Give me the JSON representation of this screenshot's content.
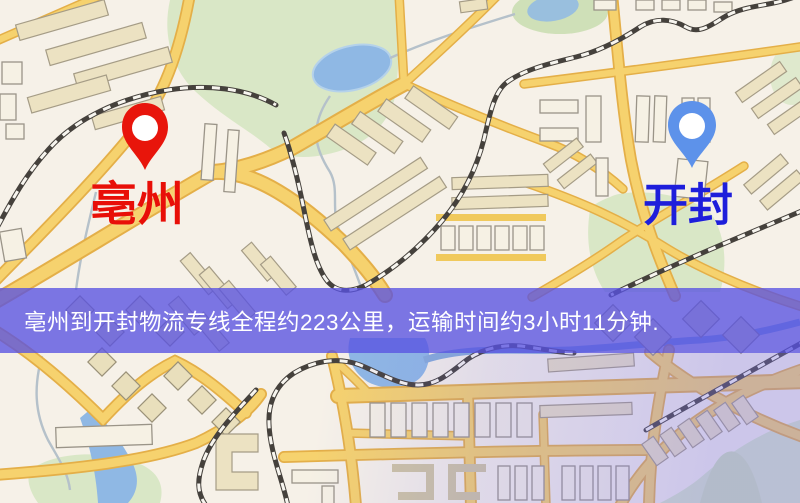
{
  "map": {
    "origin": {
      "label": "亳州",
      "pin_color": "#e8150b",
      "label_color": "#e80f08"
    },
    "destination": {
      "label": "开封",
      "pin_color": "#5d92ea",
      "label_color": "#1e1edb"
    }
  },
  "banner": {
    "text": "亳州到开封物流专线全程约223公里，运输时间约3小时11分钟.",
    "background": "rgba(88,82,226,0.78)",
    "text_color": "#ffffff"
  },
  "palette": {
    "map_base": "#f6f1e8",
    "road": "#f6d26e",
    "park": "#d9e7c6",
    "water": "#8fb8e4",
    "railway": "#45413c"
  }
}
